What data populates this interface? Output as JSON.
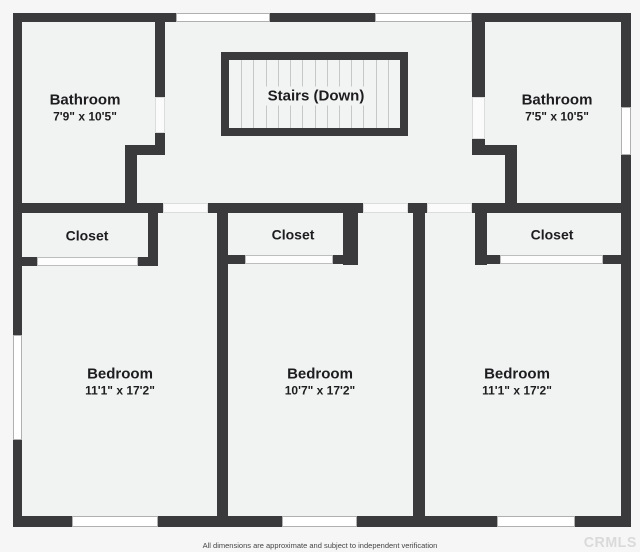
{
  "page": {
    "width": 640,
    "height": 552
  },
  "palette": {
    "background": "#f6f6f6",
    "wall": "#3a3a3c",
    "floor": "#f1f2f2",
    "stair_fill": "#f2f3f3",
    "stair_tread": "#c7c7c7",
    "window_border": "#b0b0b0",
    "door_border": "#bdbdbd",
    "label_ink": "#1d1d1f",
    "watermark_gray": "#dadada"
  },
  "floorplan": {
    "building": {
      "x": 13,
      "y": 13,
      "w": 618,
      "h": 514
    },
    "rooms": [
      {
        "id": "bathroom-left",
        "label": "Bathroom",
        "dimensions": "7'9\" x 10'5\"",
        "label_x": 85,
        "label_y": 108
      },
      {
        "id": "bathroom-right",
        "label": "Bathroom",
        "dimensions": "7'5\" x 10'5\"",
        "label_x": 557,
        "label_y": 108
      },
      {
        "id": "closet-left",
        "label": "Closet",
        "dimensions": "",
        "label_x": 87,
        "label_y": 236
      },
      {
        "id": "closet-middle",
        "label": "Closet",
        "dimensions": "",
        "label_x": 293,
        "label_y": 235
      },
      {
        "id": "closet-right",
        "label": "Closet",
        "dimensions": "",
        "label_x": 552,
        "label_y": 235
      },
      {
        "id": "bedroom-left",
        "label": "Bedroom",
        "dimensions": "11'1\" x 17'2\"",
        "label_x": 120,
        "label_y": 382
      },
      {
        "id": "bedroom-middle",
        "label": "Bedroom",
        "dimensions": "10'7\" x 17'2\"",
        "label_x": 320,
        "label_y": 382
      },
      {
        "id": "bedroom-right",
        "label": "Bedroom",
        "dimensions": "11'1\" x 17'2\"",
        "label_x": 517,
        "label_y": 382
      }
    ],
    "stairs": {
      "label": "Stairs (Down)",
      "x": 221,
      "y": 52,
      "w": 187,
      "h": 84,
      "wall": 8,
      "treads": 13,
      "label_x": 316,
      "label_y": 96
    },
    "walls": [
      {
        "name": "outer-top-1",
        "x": 13,
        "y": 13,
        "w": 163,
        "h": 9
      },
      {
        "name": "outer-top-2",
        "x": 270,
        "y": 13,
        "w": 105,
        "h": 9
      },
      {
        "name": "outer-top-3",
        "x": 472,
        "y": 13,
        "w": 159,
        "h": 9
      },
      {
        "name": "outer-left-1",
        "x": 13,
        "y": 13,
        "w": 9,
        "h": 322
      },
      {
        "name": "outer-left-2",
        "x": 13,
        "y": 440,
        "w": 9,
        "h": 87
      },
      {
        "name": "outer-right-1",
        "x": 621,
        "y": 13,
        "w": 10,
        "h": 94
      },
      {
        "name": "outer-right-2",
        "x": 621,
        "y": 155,
        "w": 10,
        "h": 372
      },
      {
        "name": "outer-bottom-1",
        "x": 13,
        "y": 516,
        "w": 59,
        "h": 11
      },
      {
        "name": "outer-bottom-2",
        "x": 158,
        "y": 516,
        "w": 124,
        "h": 11
      },
      {
        "name": "outer-bottom-3",
        "x": 357,
        "y": 516,
        "w": 140,
        "h": 11
      },
      {
        "name": "outer-bottom-4",
        "x": 575,
        "y": 516,
        "w": 56,
        "h": 11
      },
      {
        "name": "hall-wall-1",
        "x": 13,
        "y": 203,
        "w": 150,
        "h": 10
      },
      {
        "name": "hall-wall-2",
        "x": 208,
        "y": 203,
        "w": 155,
        "h": 10
      },
      {
        "name": "hall-wall-3",
        "x": 408,
        "y": 203,
        "w": 19,
        "h": 10
      },
      {
        "name": "hall-wall-4",
        "x": 472,
        "y": 203,
        "w": 159,
        "h": 10
      },
      {
        "name": "bathroom-left-wall-upper",
        "x": 155,
        "y": 13,
        "w": 10,
        "h": 84
      },
      {
        "name": "bathroom-left-wall-lower",
        "x": 155,
        "y": 133,
        "w": 10,
        "h": 22
      },
      {
        "name": "bathroom-left-notch-h",
        "x": 125,
        "y": 145,
        "w": 40,
        "h": 10
      },
      {
        "name": "bathroom-left-notch-v",
        "x": 125,
        "y": 145,
        "w": 12,
        "h": 58
      },
      {
        "name": "bathroom-right-wall-upper",
        "x": 472,
        "y": 13,
        "w": 13,
        "h": 84
      },
      {
        "name": "bathroom-right-wall-lower",
        "x": 472,
        "y": 139,
        "w": 13,
        "h": 16
      },
      {
        "name": "bathroom-right-notch-h",
        "x": 472,
        "y": 145,
        "w": 45,
        "h": 10
      },
      {
        "name": "bathroom-right-notch-v",
        "x": 505,
        "y": 145,
        "w": 12,
        "h": 58
      },
      {
        "name": "bedroom-divider-left",
        "x": 217,
        "y": 203,
        "w": 11,
        "h": 324
      },
      {
        "name": "bedroom-divider-right",
        "x": 413,
        "y": 203,
        "w": 12,
        "h": 324
      },
      {
        "name": "closet-left-sidewall",
        "x": 148,
        "y": 203,
        "w": 10,
        "h": 62
      },
      {
        "name": "closet-left-bottom-1",
        "x": 13,
        "y": 257,
        "w": 24,
        "h": 9
      },
      {
        "name": "closet-left-bottom-2",
        "x": 138,
        "y": 257,
        "w": 20,
        "h": 9
      },
      {
        "name": "closet-middle-sidewall",
        "x": 343,
        "y": 203,
        "w": 15,
        "h": 62
      },
      {
        "name": "closet-middle-bottom-1",
        "x": 217,
        "y": 255,
        "w": 28,
        "h": 9
      },
      {
        "name": "closet-middle-bottom-2",
        "x": 333,
        "y": 255,
        "w": 25,
        "h": 9
      },
      {
        "name": "closet-right-sidewall",
        "x": 475,
        "y": 203,
        "w": 12,
        "h": 62
      },
      {
        "name": "closet-right-bottom-1",
        "x": 475,
        "y": 255,
        "w": 25,
        "h": 9
      },
      {
        "name": "closet-right-bottom-2",
        "x": 603,
        "y": 255,
        "w": 28,
        "h": 9
      }
    ],
    "windows": [
      {
        "name": "window-top-left",
        "x": 176,
        "y": 13,
        "w": 94,
        "h": 9
      },
      {
        "name": "window-top-right",
        "x": 375,
        "y": 13,
        "w": 97,
        "h": 9
      },
      {
        "name": "window-left",
        "x": 13,
        "y": 335,
        "w": 9,
        "h": 105
      },
      {
        "name": "window-right",
        "x": 621,
        "y": 107,
        "w": 10,
        "h": 48
      },
      {
        "name": "window-bottom-left",
        "x": 72,
        "y": 516,
        "w": 86,
        "h": 11
      },
      {
        "name": "window-bottom-middle",
        "x": 282,
        "y": 516,
        "w": 75,
        "h": 11
      },
      {
        "name": "window-bottom-right",
        "x": 497,
        "y": 516,
        "w": 78,
        "h": 11
      }
    ],
    "closet_doors": [
      {
        "name": "closet-left-door",
        "x": 37,
        "y": 257,
        "w": 101,
        "h": 9
      },
      {
        "name": "closet-middle-door",
        "x": 245,
        "y": 255,
        "w": 88,
        "h": 9
      },
      {
        "name": "closet-right-door",
        "x": 500,
        "y": 255,
        "w": 103,
        "h": 9
      }
    ],
    "door_openings": [
      {
        "name": "door-opening-bedroom-left",
        "x": 163,
        "y": 203,
        "w": 45,
        "h": 10
      },
      {
        "name": "door-opening-bedroom-middle",
        "x": 363,
        "y": 203,
        "w": 45,
        "h": 10
      },
      {
        "name": "door-opening-bedroom-right",
        "x": 427,
        "y": 203,
        "w": 45,
        "h": 10
      },
      {
        "name": "door-opening-bathroom-left",
        "x": 155,
        "y": 97,
        "w": 10,
        "h": 36
      },
      {
        "name": "door-opening-bathroom-right",
        "x": 472,
        "y": 97,
        "w": 13,
        "h": 42
      }
    ]
  },
  "footer": {
    "disclaimer": "All dimensions are approximate and subject to independent verification",
    "watermark": "CRMLS"
  }
}
